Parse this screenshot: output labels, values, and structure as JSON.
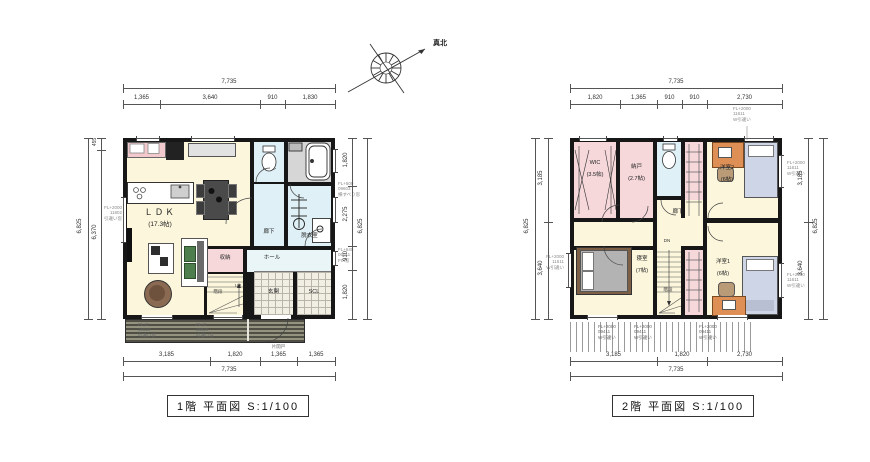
{
  "compass": {
    "north_label": "真北"
  },
  "floor1": {
    "caption": "1階 平面図 S:1/100",
    "dim_top_total": "7,735",
    "dim_top_segments": [
      "1,365",
      "3,640",
      "910",
      "1,830"
    ],
    "dim_bottom_segments": [
      "3,185",
      "1,820",
      "1,365",
      "1,365"
    ],
    "dim_bottom_total": "7,735",
    "dim_left_total": "6,825",
    "dim_left_segments": [
      "455",
      "6,370"
    ],
    "dim_right_segments": [
      "1,820",
      "2,275",
      "910",
      "1,820"
    ],
    "dim_right_total": "6,825",
    "rooms": {
      "ldk": "ＬＤＫ",
      "ldk_size": "(17.3帖)",
      "toilet": "トイレ",
      "corridor": "廊下",
      "dressing": "脱衣室",
      "closet": "収納",
      "hall": "ホール",
      "entrance": "玄関",
      "scl": "SCL",
      "stairs": "階段",
      "up": "UP"
    },
    "ann": {
      "win_left": "FL+2000\n11802\n引違い窓",
      "win_bath": "FL+500\n09603\n横すべり窓",
      "win_hall": "FL+640\n06011\nFIX窓",
      "deck_a": "FL+0\n16520\n引違い窓",
      "deck_b": "FL+0\n16520\n引違い窓",
      "hinged_door": "片開戸"
    }
  },
  "floor2": {
    "caption": "2階 平面図 S:1/100",
    "dim_top_total": "7,735",
    "dim_top_segments": [
      "1,820",
      "1,365",
      "910",
      "910",
      "2,730"
    ],
    "dim_bottom_segments": [
      "3,185",
      "1,820",
      "2,730"
    ],
    "dim_bottom_total": "7,735",
    "dim_left_total": "6,825",
    "dim_left_segments": [
      "3,185",
      "3,640"
    ],
    "dim_right_segments": [
      "3,185",
      "3,640"
    ],
    "dim_right_total": "6,825",
    "rooms": {
      "wic": "WIC",
      "wic_size": "(3.5帖)",
      "nando": "納戸",
      "nando_size": "(2.7帖)",
      "toilet": "トイレ",
      "corridor": "廊下",
      "bedroom": "寝室",
      "bedroom_size": "(7帖)",
      "western2": "洋室2",
      "western2_size": "(6帖)",
      "western1": "洋室1",
      "western1_size": "(6帖)",
      "stairs": "階段",
      "dn": "DN"
    },
    "ann": {
      "win_top": "FL+2000\n11611\nW引違い",
      "win_right_a": "FL+2000\n11611\nW引違い",
      "win_right_b": "FL+2000\n11611\nW引違い",
      "win_left": "FL+2000\n11611\nW引違い",
      "roof_a": "FL+2000\n09411\nW引違い",
      "roof_b": "FL+2000\n09411\nW引違い",
      "roof_c": "FL+2000\n09411\nW引違い"
    }
  }
}
